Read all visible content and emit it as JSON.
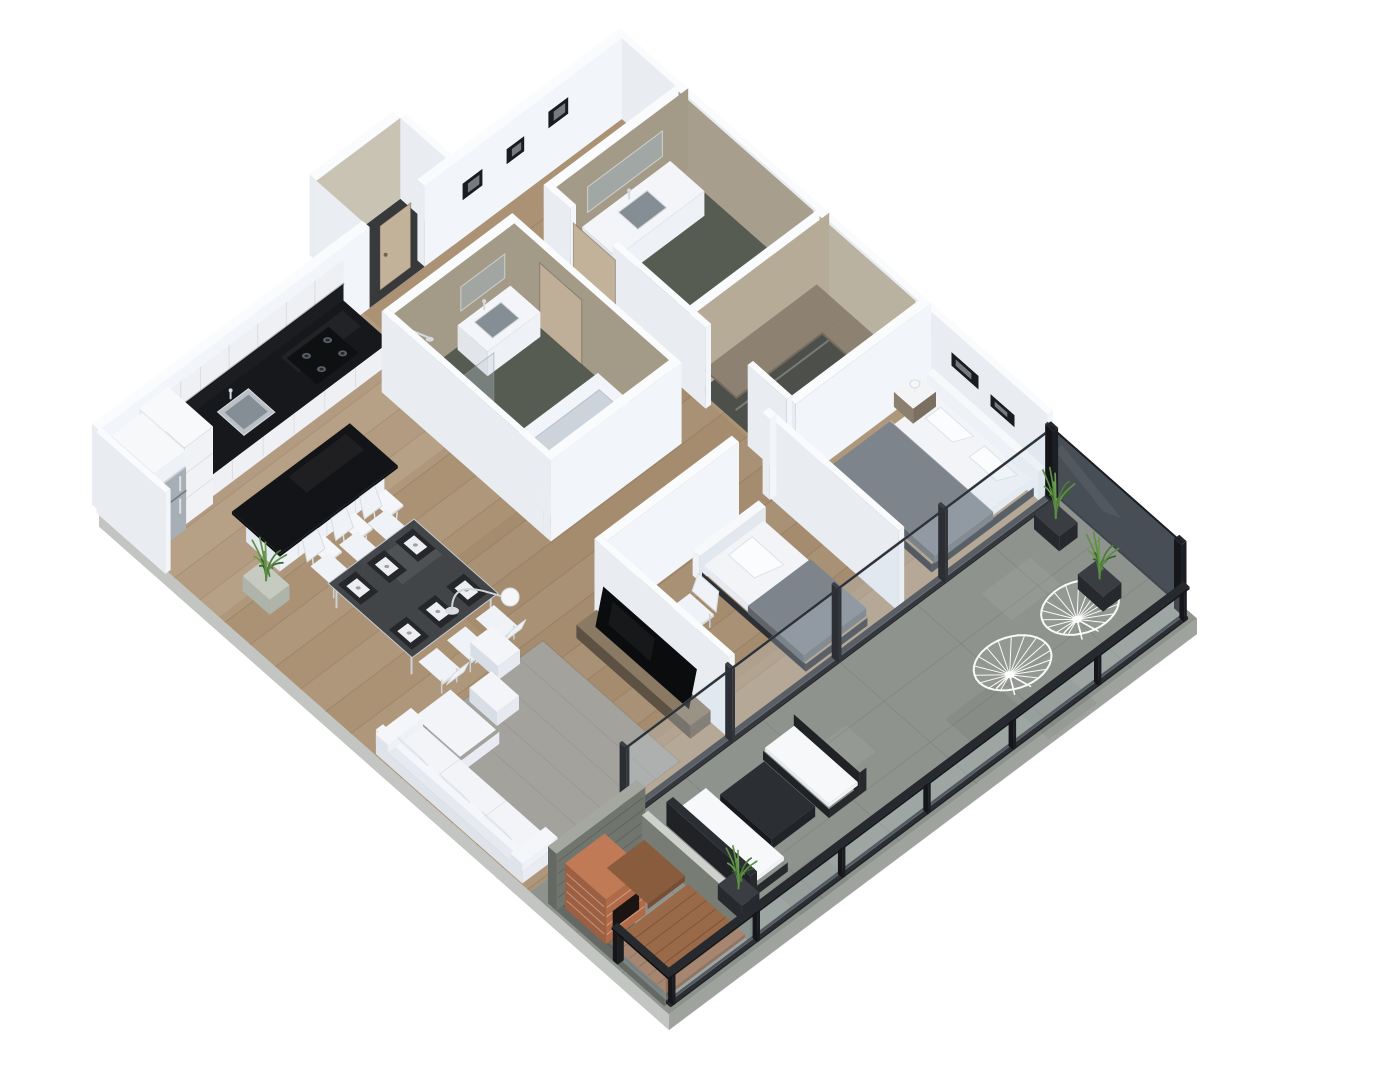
{
  "meta": {
    "title": "3D isometric apartment floor plan rendering",
    "render_type": "architectural-visualization",
    "background": "#ffffff"
  },
  "palette": {
    "wallFaceU": "#e9edf2",
    "wallFaceV": "#f2f5f9",
    "wallTop": "#fafbfd",
    "tanTile": "#a39a87",
    "tanLight": "#c9c3b4",
    "doorTan": "#c3b29a",
    "wood": "#ab9274",
    "woodLine": "rgba(110,85,55,0.22)",
    "bathFloor": "#575c53",
    "showerFloor": "#495046",
    "closetFloor": "#4c4f4a",
    "entryFloor": "#37393b",
    "concrete": "#8e948d",
    "slabEdgeLeft": "#c2c5c1",
    "slabEdgeBottom": "#9fa39e",
    "counterTop": "#17181b",
    "cabinetFace": "#eef0f4",
    "cabinetSide": "#e2e7ed",
    "backsplash": "#1b1d20",
    "steel": "#b9c0c6",
    "steelDark": "#868e95",
    "fridgeFront": "#a7aeb5",
    "fridgeSide": "#848b92",
    "fridgeTop": "#ccd1d6",
    "islandBlack": "#131417",
    "sofaTop": "#f2f4f8",
    "sofaSideU": "#dfe4eb",
    "sofaSideV": "#e8ecf2",
    "pillow": "#fbfcfe",
    "blanketTop": "#7e848c",
    "blanketSideU": "#5f646b",
    "blanketSideV": "#6b7077",
    "rug": "#a3a29c",
    "tvBlack": "#0b0c0e",
    "woodFurnTop": "#8a7a64",
    "woodFurnV": "#6e6252",
    "woodFurnU": "#5c5142",
    "closetWoodTop": "#8d8172",
    "closetWoodSide": "#756a5c",
    "darkFurn": "#202225",
    "darkFurnV": "#27292c",
    "glass": "rgba(205,220,233,0.25)",
    "glassStroke": "rgba(130,142,152,0.5)",
    "railBlack": "#15171a",
    "screenGlass": "rgba(56,63,72,0.92)",
    "plantGreen": "#4d7a39",
    "plantGreen2": "#6b9a50",
    "plantDark": "#39612c",
    "planterDark": "#26292d",
    "potGray": "#aeb4a9",
    "brick": "#b06a48",
    "brickSide": "#9c5f42",
    "brickTop": "#c07a55",
    "deckWood": "#9a6a48",
    "slatWall": "#70756e",
    "slatWallU": "#646963",
    "frameDark": "#1a1c1f",
    "artSmudge": "#c4c9cf",
    "chrome": "#d5dade",
    "white": "#ffffff"
  },
  "scene": {
    "layers": [
      {
        "name": "base",
        "items": [
          "slab-edge-left",
          "slab-edge-bottom",
          "balcony-floor",
          "wood-floor",
          "bathroom1-floor",
          "bathroom2-floor",
          "shower-floor",
          "closet-floor",
          "living-rug"
        ]
      },
      {
        "name": "shell",
        "items": [
          "entry-nook",
          "entry-door",
          "wall-gallery",
          "gallery-pictures",
          "wall-kitchen-side",
          "wall-right-outer",
          "master-wall-art"
        ]
      },
      {
        "name": "kitchen",
        "items": [
          "kitchen-backsplash",
          "kitchen-upper-cabinets",
          "kitchen-counter",
          "kitchen-cooktop",
          "kitchen-sink",
          "kitchen-tall-cabinet",
          "kitchen-fridge",
          "kitchen-end-wall",
          "kitchen-island",
          "kitchen-bar-stools",
          "kitchen-island-plant"
        ]
      },
      {
        "name": "bathroom1",
        "items": [
          "bath1-back-walls",
          "bath1-mirror",
          "bath1-vanity",
          "bath1-toilet"
        ]
      },
      {
        "name": "closet",
        "items": [
          "closet-divider-wall",
          "closet-counters",
          "closet-front-wall"
        ]
      },
      {
        "name": "hall",
        "items": [
          "hallway-wall",
          "hallway-doors"
        ]
      },
      {
        "name": "master-bedroom",
        "items": [
          "master-bed",
          "master-nightstand",
          "master-bedroom-wall"
        ]
      },
      {
        "name": "bathroom2",
        "items": [
          "bath2-back-walls",
          "bath2-door",
          "bath2-mirror",
          "bath2-vanity",
          "bath2-shower",
          "bath2-bathtub",
          "bath2-front-walls"
        ]
      },
      {
        "name": "bedroom2",
        "items": [
          "bedroom2-back-wall",
          "bedroom2-bed",
          "bedroom2-desk",
          "bedroom2-desk-chair",
          "bedroom2-wall",
          "living-tv-unit"
        ]
      },
      {
        "name": "dining",
        "items": [
          "dining-chairs-back",
          "dining-table",
          "dining-place-settings",
          "dining-chairs-front"
        ]
      },
      {
        "name": "living",
        "items": [
          "living-floor-lamp",
          "living-ottomans",
          "living-sofa"
        ]
      },
      {
        "name": "glazing",
        "items": [
          "sliding-glass-doors",
          "privacy-screen"
        ]
      },
      {
        "name": "balcony",
        "items": [
          "balcony-enclosure",
          "brick-barbecue",
          "wood-deck",
          "outdoor-lounge-set",
          "acapulco-chairs",
          "balcony-planters",
          "corner-plant"
        ]
      },
      {
        "name": "front",
        "items": [
          "glass-railing"
        ]
      }
    ],
    "rooms": [
      {
        "name": "kitchen",
        "furniture": [
          "refrigerator",
          "counter-with-sink",
          "cooktop",
          "upper-cabinets",
          "island",
          "bar-stools",
          "plant"
        ]
      },
      {
        "name": "dining-area",
        "furniture": [
          "glass-table",
          "six-chairs",
          "place-settings"
        ]
      },
      {
        "name": "living-room",
        "furniture": [
          "sectional-sofa",
          "rug",
          "ottomans",
          "arc-floor-lamp",
          "tv",
          "tv-console"
        ]
      },
      {
        "name": "bathroom-top",
        "furniture": [
          "vanity-sink",
          "toilet",
          "mirror"
        ]
      },
      {
        "name": "bathroom-main",
        "furniture": [
          "bathtub",
          "vanity-sink",
          "shower"
        ]
      },
      {
        "name": "walk-in-closet",
        "furniture": [
          "wood-counters"
        ]
      },
      {
        "name": "master-bedroom",
        "furniture": [
          "double-bed",
          "nightstand",
          "lamp",
          "wall-art"
        ]
      },
      {
        "name": "bedroom-2",
        "furniture": [
          "single-bed",
          "desk",
          "chair"
        ]
      },
      {
        "name": "balcony",
        "furniture": [
          "glass-railing",
          "privacy-screen",
          "acapulco-wire-chairs",
          "outdoor-lounge-set",
          "planters",
          "brick-barbecue",
          "wood-deck"
        ]
      },
      {
        "name": "entry",
        "furniture": [
          "door"
        ]
      }
    ]
  }
}
